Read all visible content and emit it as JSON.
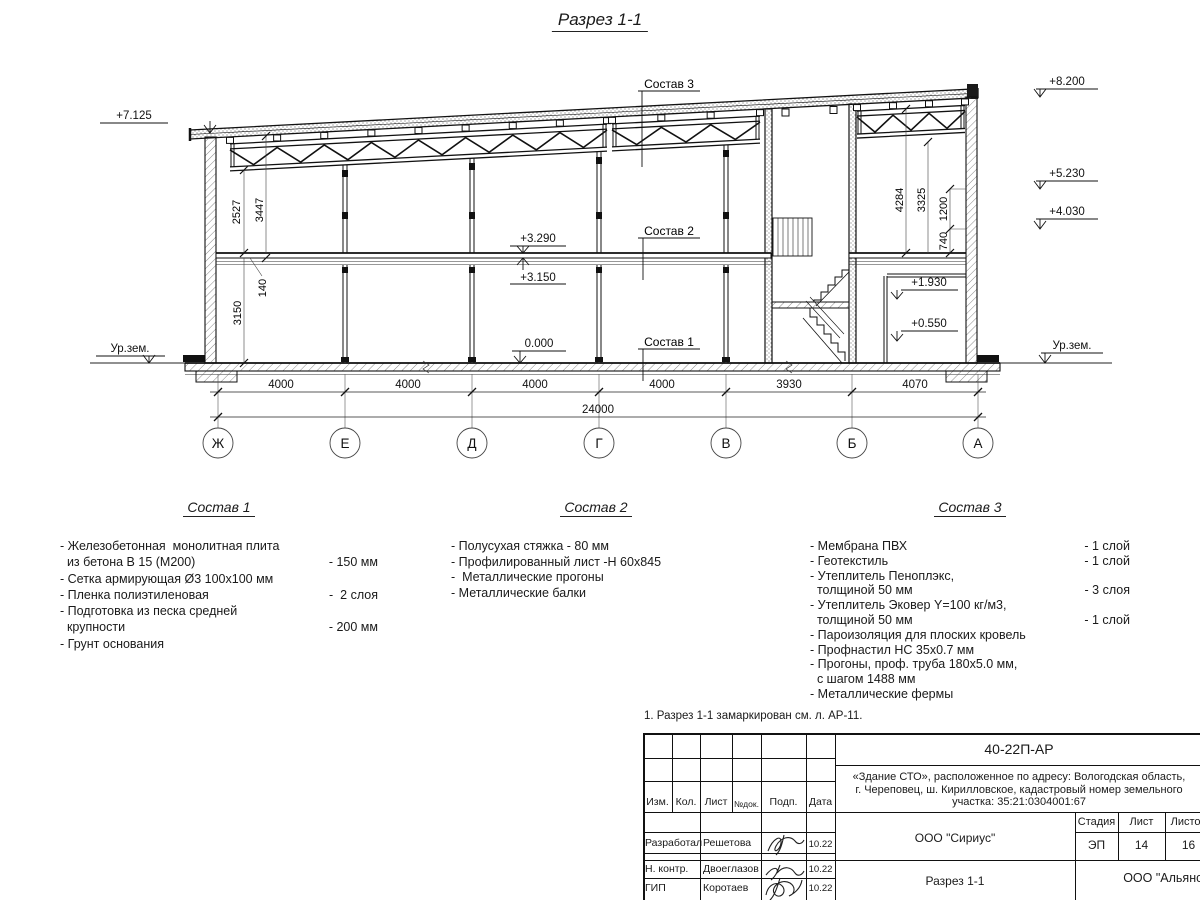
{
  "title": "Разрез 1-1",
  "drawing": {
    "marks": {
      "top_left": "+7.125",
      "top_right": "+8.200",
      "r5230": "+5.230",
      "r4030": "+4.030",
      "f3290": "+3.290",
      "f3150": "+3.150",
      "zero": "0.000",
      "m1930": "+1.930",
      "m0550": "+0.550",
      "ground": "Ур.зем."
    },
    "layers": {
      "s1": "Состав 1",
      "s2": "Состав 2",
      "s3": "Состав 3"
    },
    "vdims": {
      "v2527": "2527",
      "v3447": "3447",
      "v3150": "3150",
      "v140": "140",
      "v4284": "4284",
      "v3325": "3325",
      "v1200": "1200",
      "v740": "740"
    },
    "dims": [
      "4000",
      "4000",
      "4000",
      "4000",
      "3930",
      "4070"
    ],
    "total": "24000",
    "axes": [
      "Ж",
      "Е",
      "Д",
      "Г",
      "В",
      "Б",
      "А"
    ]
  },
  "comp1": {
    "title": "Состав 1",
    "rows": [
      {
        "t": "- Железобетонная  монолитная плита",
        "v": ""
      },
      {
        "t": "  из бетона В 15 (М200)",
        "v": "- 150 мм"
      },
      {
        "t": "- Сетка армирующая Ø3 100х100 мм",
        "v": ""
      },
      {
        "t": "- Пленка полиэтиленовая",
        "v": "-  2 слоя"
      },
      {
        "t": "- Подготовка из песка средней",
        "v": ""
      },
      {
        "t": "  крупности",
        "v": "- 200 мм"
      },
      {
        "t": "- Грунт основания",
        "v": ""
      }
    ]
  },
  "comp2": {
    "title": "Состав 2",
    "rows": [
      {
        "t": "- Полусухая стяжка - 80 мм"
      },
      {
        "t": "- Профилированный лист -Н 60х845"
      },
      {
        "t": "-  Металлические прогоны"
      },
      {
        "t": "- Металлические балки"
      }
    ]
  },
  "comp3": {
    "title": "Состав 3",
    "rows": [
      {
        "t": "- Мембрана ПВХ",
        "v": "- 1 слой"
      },
      {
        "t": "- Геотекстиль",
        "v": "- 1 слой"
      },
      {
        "t": "- Утеплитель Пеноплэкс,",
        "v": ""
      },
      {
        "t": "  толщиной 50 мм",
        "v": "- 3 слоя"
      },
      {
        "t": "- Утеплитель Эковер Y=100 кг/м3,",
        "v": ""
      },
      {
        "t": "  толщиной 50 мм",
        "v": "- 1 слой"
      },
      {
        "t": "- Пароизоляция для плоских кровель",
        "v": "- 1 слой"
      },
      {
        "t": "- Профнастил НС 35х0.7 мм",
        "v": ""
      },
      {
        "t": "- Прогоны, проф. труба 180х5.0 мм,",
        "v": ""
      },
      {
        "t": "  с шагом 1488 мм",
        "v": ""
      },
      {
        "t": "- Металлические фермы",
        "v": ""
      }
    ]
  },
  "note": "1. Разрез 1-1 замаркирован см. л. АР-11.",
  "titleblock": {
    "doc_number": "40-22П-АР",
    "address": [
      "«Здание СТО», расположенное по адресу: Вологодская область,",
      "г. Череповец, ш. Кирилловское, кадастровый номер земельного",
      "участка: 35:21:0304001:67"
    ],
    "cols": {
      "izm": "Изм.",
      "kol": "Кол.",
      "list": "Лист",
      "ndok": "№док.",
      "podp": "Подп.",
      "data": "Дата"
    },
    "rows": [
      {
        "role": "Разработал",
        "name": "Решетова",
        "date": "10.22"
      },
      {
        "role": "Н. контр.",
        "name": "Двоеглазов",
        "date": "10.22"
      },
      {
        "role": "ГИП",
        "name": "Коротаев",
        "date": "10.22"
      }
    ],
    "org1": "ООО \"Сириус\"",
    "sheet_title": "Разрез 1-1",
    "org2": "ООО \"Альянс\"",
    "stage_label": "Стадия",
    "sheet_label": "Лист",
    "sheets_label": "Листов",
    "stage": "ЭП",
    "sheet_no": "14",
    "sheets_total": "16"
  }
}
